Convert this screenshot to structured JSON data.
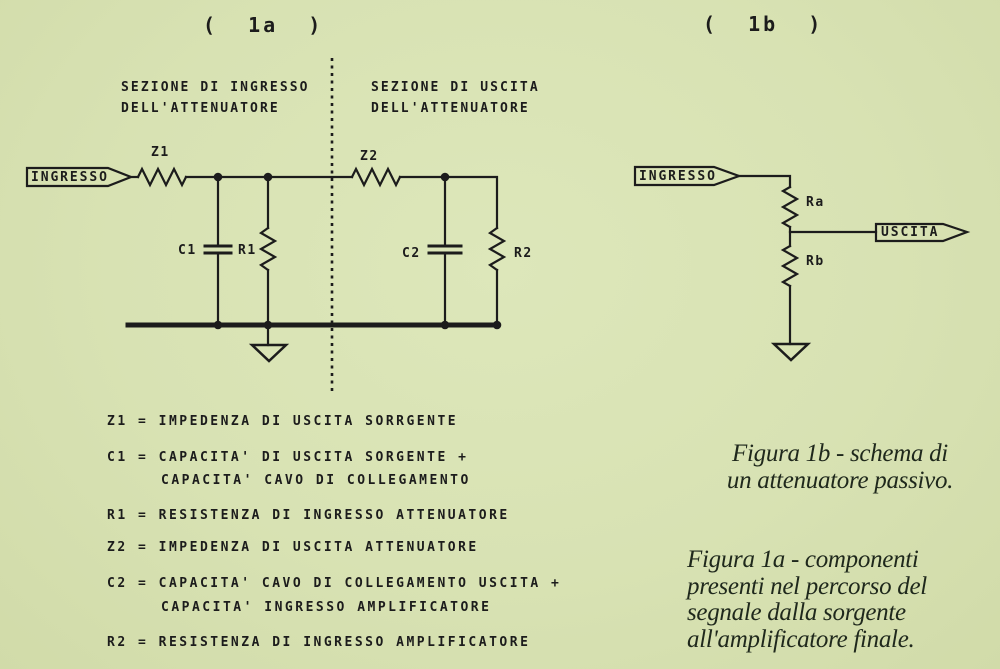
{
  "palette": {
    "paper": "#d8e2b3",
    "ink": "#1c1c1c",
    "caption_ink": "#1f281c"
  },
  "figure_1a": {
    "title": "(  1a  )",
    "input_section_line1": "SEZIONE DI INGRESSO",
    "input_section_line2": "DELL'ATTENUATORE",
    "output_section_line1": "SEZIONE DI USCITA",
    "output_section_line2": "DELL'ATTENUATORE",
    "input_tag": "INGRESSO",
    "labels": {
      "z1": "Z1",
      "c1": "C1",
      "r1": "R1",
      "z2": "Z2",
      "c2": "C2",
      "r2": "R2"
    }
  },
  "figure_1b": {
    "title": "(  1b  )",
    "input_tag": "INGRESSO",
    "output_tag": "USCITA",
    "labels": {
      "ra": "Ra",
      "rb": "Rb"
    }
  },
  "legend": {
    "rows": [
      {
        "text": "Z1 = IMPEDENZA DI USCITA SORRGENTE"
      },
      {
        "text": "C1 = CAPACITA' DI USCITA SORGENTE +"
      },
      {
        "text": "CAPACITA' CAVO DI COLLEGAMENTO"
      },
      {
        "text": "R1 = RESISTENZA DI INGRESSO ATTENUATORE"
      },
      {
        "text": "Z2 = IMPEDENZA DI USCITA ATTENUATORE"
      },
      {
        "text": "C2 = CAPACITA' CAVO DI COLLEGAMENTO USCITA +"
      },
      {
        "text": "CAPACITA' INGRESSO AMPLIFICATORE"
      },
      {
        "text": "R2 = RESISTENZA DI INGRESSO AMPLIFICATORE"
      }
    ]
  },
  "captions": {
    "fig1b_line1": "Figura 1b - schema di",
    "fig1b_line2": "un attenuatore passivo.",
    "fig1a_line1": "Figura 1a - componenti",
    "fig1a_line2": "presenti nel percorso del",
    "fig1a_line3": "segnale dalla sorgente",
    "fig1a_line4": "all'amplificatore finale."
  }
}
